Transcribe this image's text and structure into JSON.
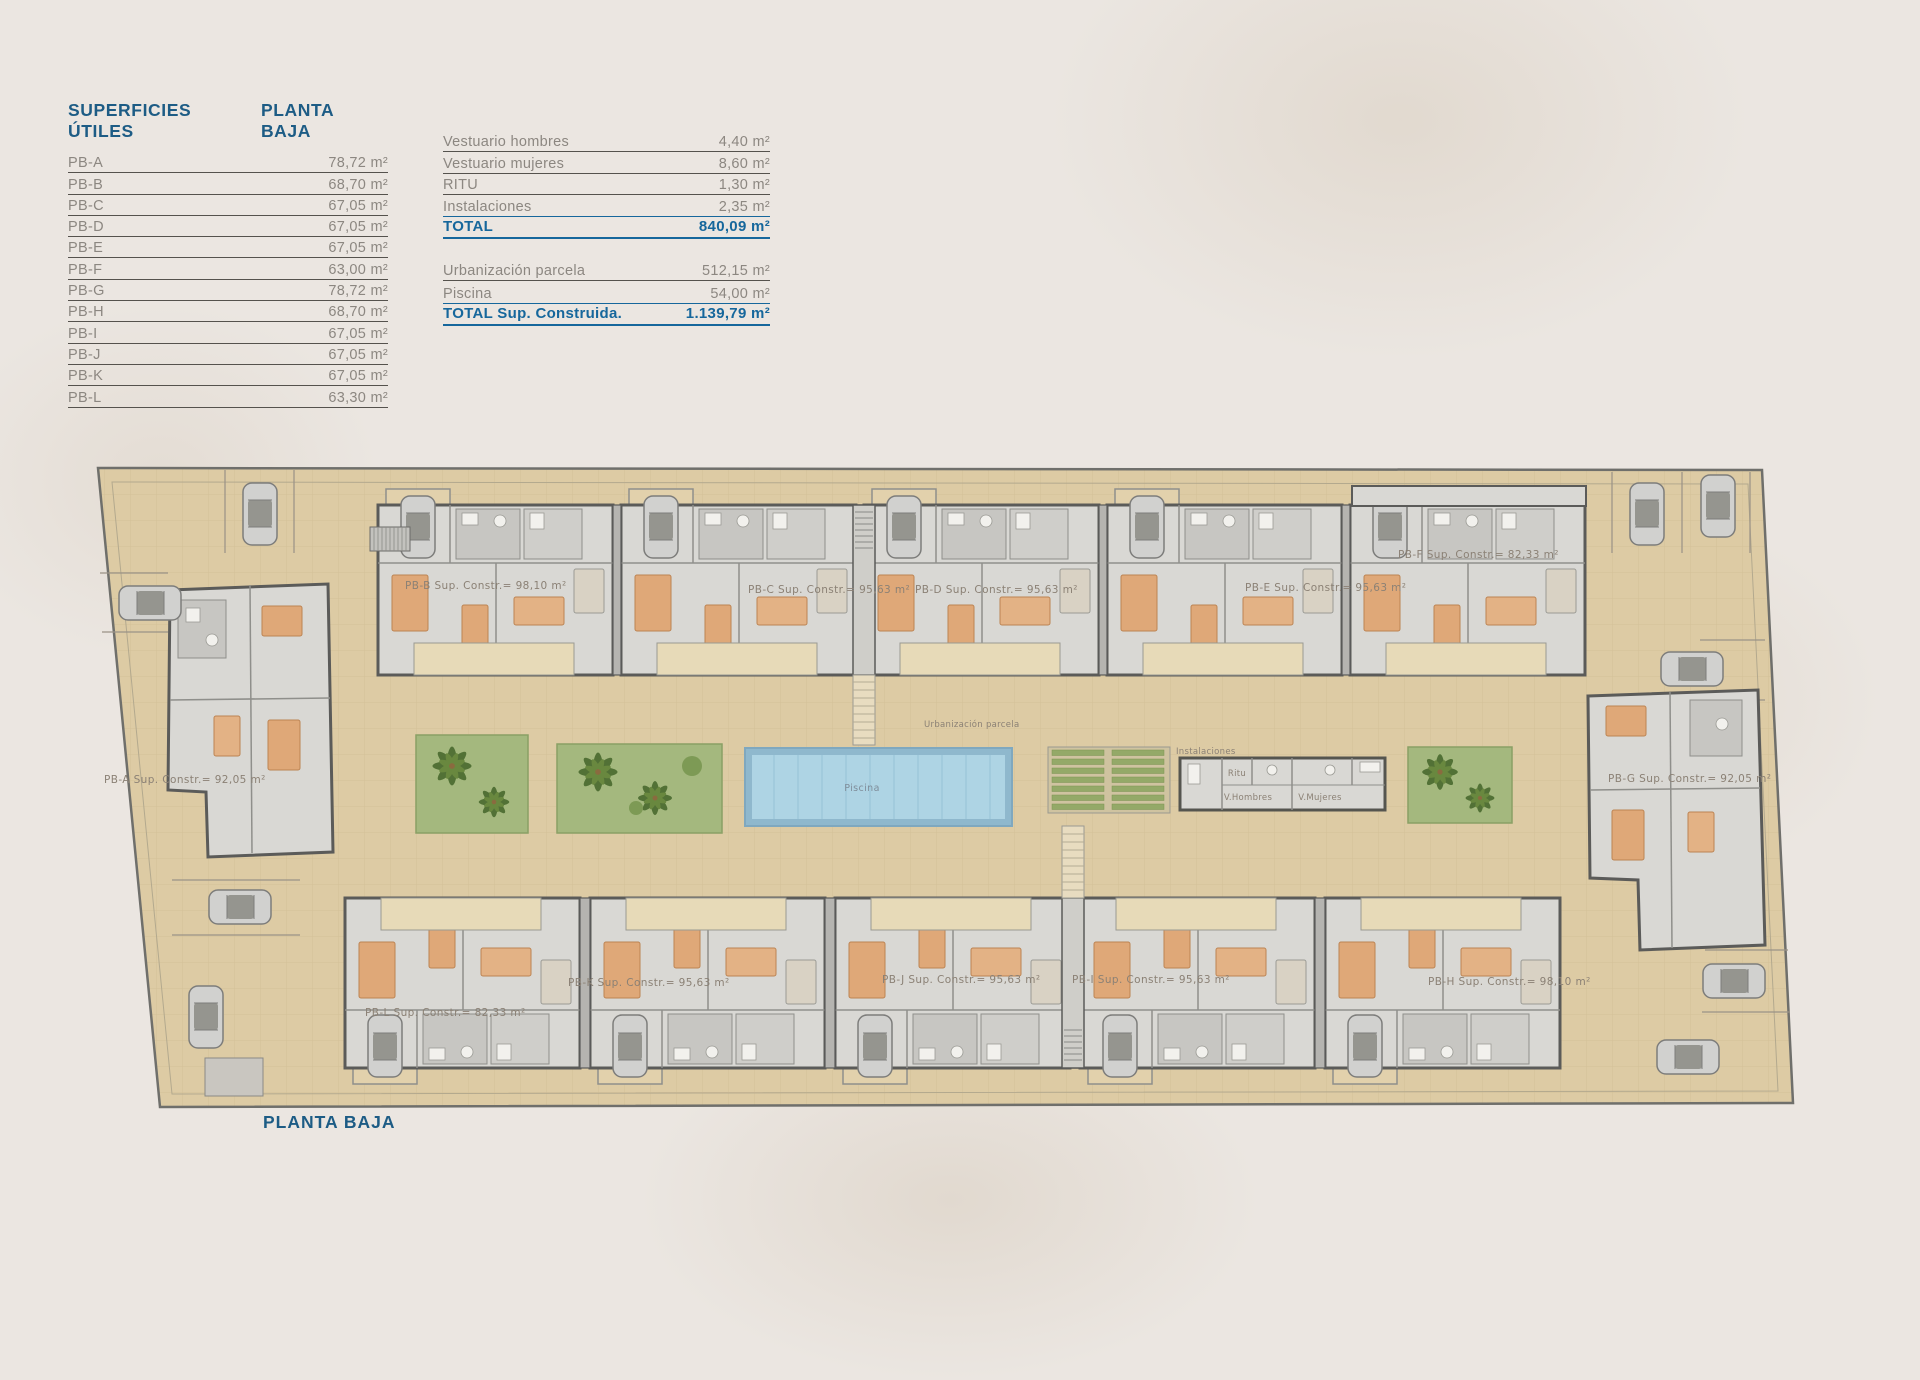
{
  "page": {
    "caption": "PLANTA BAJA"
  },
  "useful_areas_table": {
    "title": "SUPERFICIES ÚTILES",
    "subtitle": "PLANTA BAJA",
    "rows": [
      {
        "label": "PB-A",
        "value": "78,72 m²"
      },
      {
        "label": "PB-B",
        "value": "68,70 m²"
      },
      {
        "label": "PB-C",
        "value": "67,05 m²"
      },
      {
        "label": "PB-D",
        "value": "67,05 m²"
      },
      {
        "label": "PB-E",
        "value": "67,05 m²"
      },
      {
        "label": "PB-F",
        "value": "63,00 m²"
      },
      {
        "label": "PB-G",
        "value": "78,72 m²"
      },
      {
        "label": "PB-H",
        "value": "68,70 m²"
      },
      {
        "label": "PB-I",
        "value": "67,05 m²"
      },
      {
        "label": "PB-J",
        "value": "67,05 m²"
      },
      {
        "label": "PB-K",
        "value": "67,05 m²"
      },
      {
        "label": "PB-L",
        "value": "63,30 m²"
      }
    ]
  },
  "summary_table": {
    "rows": [
      {
        "label": "Vestuario hombres",
        "value": "4,40 m²"
      },
      {
        "label": "Vestuario mujeres",
        "value": "8,60 m²"
      },
      {
        "label": "RITU",
        "value": "1,30 m²"
      },
      {
        "label": "Instalaciones",
        "value": "2,35 m²"
      }
    ],
    "total": {
      "label": "TOTAL",
      "value": "840,09 m²"
    },
    "site_rows": [
      {
        "label": "Urbanización parcela",
        "value": "512,15 m²"
      },
      {
        "label": "Piscina",
        "value": "54,00 m²"
      }
    ],
    "grand_total": {
      "label": "TOTAL Sup. Construida.",
      "value": "1.139,79 m²"
    }
  },
  "plan": {
    "unit_labels": {
      "pb_a": "PB-A Sup. Constr.= 92,05 m²",
      "pb_b": "PB-B Sup. Constr.= 98,10 m²",
      "pb_c": "PB-C Sup. Constr.= 95,63 m²",
      "pb_d": "PB-D Sup. Constr.= 95,63 m²",
      "pb_e": "PB-E Sup. Constr.= 95,63 m²",
      "pb_f": "PB-F Sup. Constr.= 82,33 m²",
      "pb_g": "PB-G Sup. Constr.= 92,05 m²",
      "pb_h": "PB-H Sup. Constr.= 98,10 m²",
      "pb_i": "PB-I Sup. Constr.= 95,63 m²",
      "pb_j": "PB-J Sup. Constr.= 95,63 m²",
      "pb_k": "PB-K Sup. Constr.= 95,63 m²",
      "pb_l": "PB-L Sup. Constr.= 82,33 m²"
    },
    "area_labels": {
      "urbanizacion": "Urbanización parcela",
      "piscina": "Piscina",
      "instalaciones": "Instalaciones",
      "ritu": "Ritu",
      "v_hombres": "V.Hombres",
      "v_mujeres": "V.Mujeres"
    }
  },
  "colors": {
    "accent_blue": "#1d5c85",
    "total_blue": "#16679c",
    "table_text_gray": "#8c8781",
    "site_beige": "#ddcba4",
    "building_gray": "#d9d8d4",
    "wall_gray": "#5b5b59",
    "garden_green": "#a4b87e",
    "pool_blue": "#aed4e4",
    "furniture_orange": "#dfa878"
  }
}
